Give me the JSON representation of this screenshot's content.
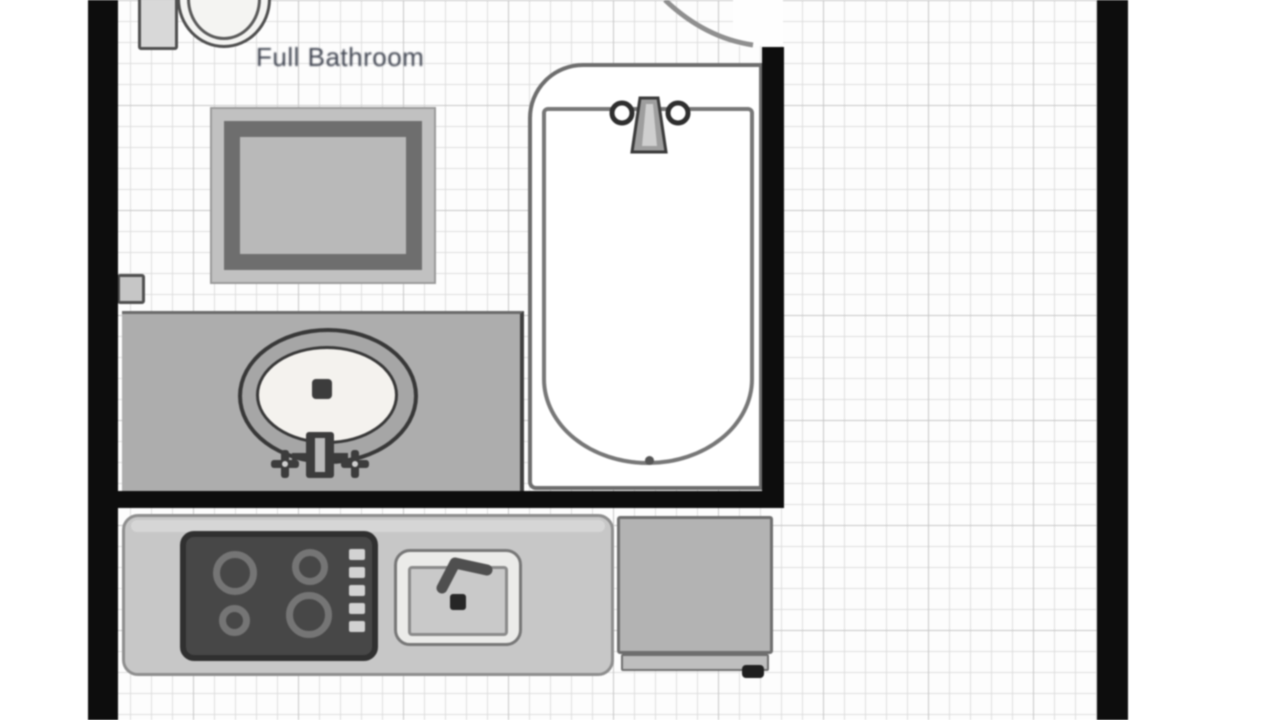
{
  "room": {
    "label": "Full Bathroom"
  },
  "colors": {
    "wall": "#0d0d0d",
    "paper": "#fdfdfd",
    "grid_minor": "#dedede",
    "grid_major": "#c6c6c6",
    "label_text": "#3f4450",
    "vanity_counter": "#adadad",
    "kitchen_counter": "#c7c7c7",
    "cooktop": "#474747",
    "appliance": "#b3b3b3",
    "fixture_outline": "#6e6e6e"
  },
  "fixtures": [
    {
      "name": "toilet"
    },
    {
      "name": "door-swing"
    },
    {
      "name": "wall-mirror"
    },
    {
      "name": "wall-fixture"
    },
    {
      "name": "vanity-with-oval-sink"
    },
    {
      "name": "bathtub"
    },
    {
      "name": "cooktop-4-burners"
    },
    {
      "name": "kitchen-sink"
    },
    {
      "name": "dishwasher"
    }
  ]
}
